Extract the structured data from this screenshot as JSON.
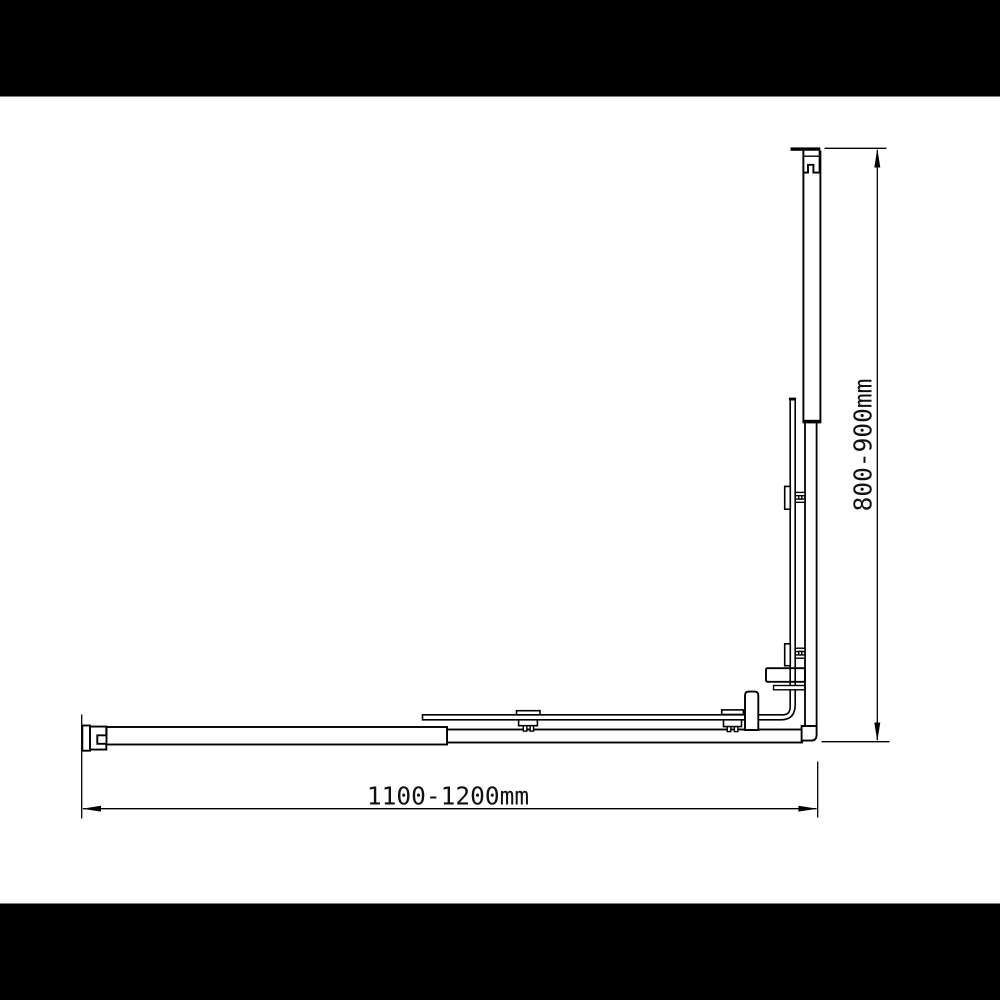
{
  "page": {
    "background": "#ffffff",
    "letterbox_color": "#000000",
    "line_color": "#000000"
  },
  "drawing": {
    "dimensions": {
      "width": {
        "label": "1100-1200mm"
      },
      "height": {
        "label": "800-900mm"
      }
    }
  }
}
